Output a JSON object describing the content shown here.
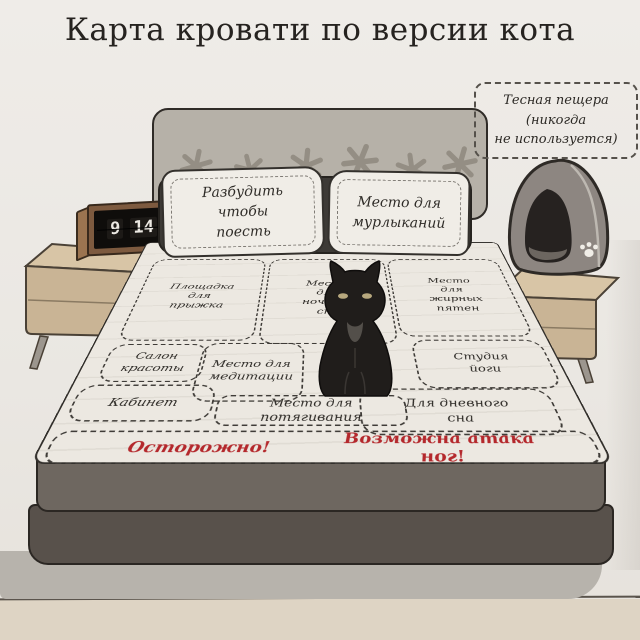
{
  "title": "Карта кровати по версии кота",
  "cave_label": {
    "lines": [
      "Тесная пещера",
      "(никогда",
      "не используется)"
    ]
  },
  "clock": {
    "hour": "9",
    "minute": "14"
  },
  "pillows": {
    "left": "Разбудить чтобы поесть",
    "right": "Место для мурлыканий"
  },
  "zones": [
    {
      "id": "jump-pad",
      "label": "Площадка для прыжка"
    },
    {
      "id": "night-sleep",
      "label": "Место для ночного сна"
    },
    {
      "id": "grease-spots",
      "label": "Место для жирных пятен"
    },
    {
      "id": "beauty-salon",
      "label": "Салон красоты"
    },
    {
      "id": "meditation",
      "label": "Место для медитации"
    },
    {
      "id": "yoga-studio",
      "label": "Студия йоги"
    },
    {
      "id": "office",
      "label": "Кабинет"
    },
    {
      "id": "stretching",
      "label": "Место для потягивания"
    },
    {
      "id": "day-sleep",
      "label": "Для дневного сна"
    }
  ],
  "warnings": {
    "left": "Осторожно!",
    "right": "Возможна атака ног!"
  },
  "colors": {
    "warning_red": "#b4282c",
    "ink": "#2d2a26",
    "sheet": "#ece8e1",
    "wall": "#edeae5",
    "floor": "#ded4c4",
    "wood": "#c9b495",
    "headboard": "#b6b1a8",
    "cat_black": "#201d1b",
    "cat_house_gray": "#8d8681"
  },
  "icons": {
    "paw_print_icon": "paw-print",
    "star_motif_icon": "star-motif"
  }
}
